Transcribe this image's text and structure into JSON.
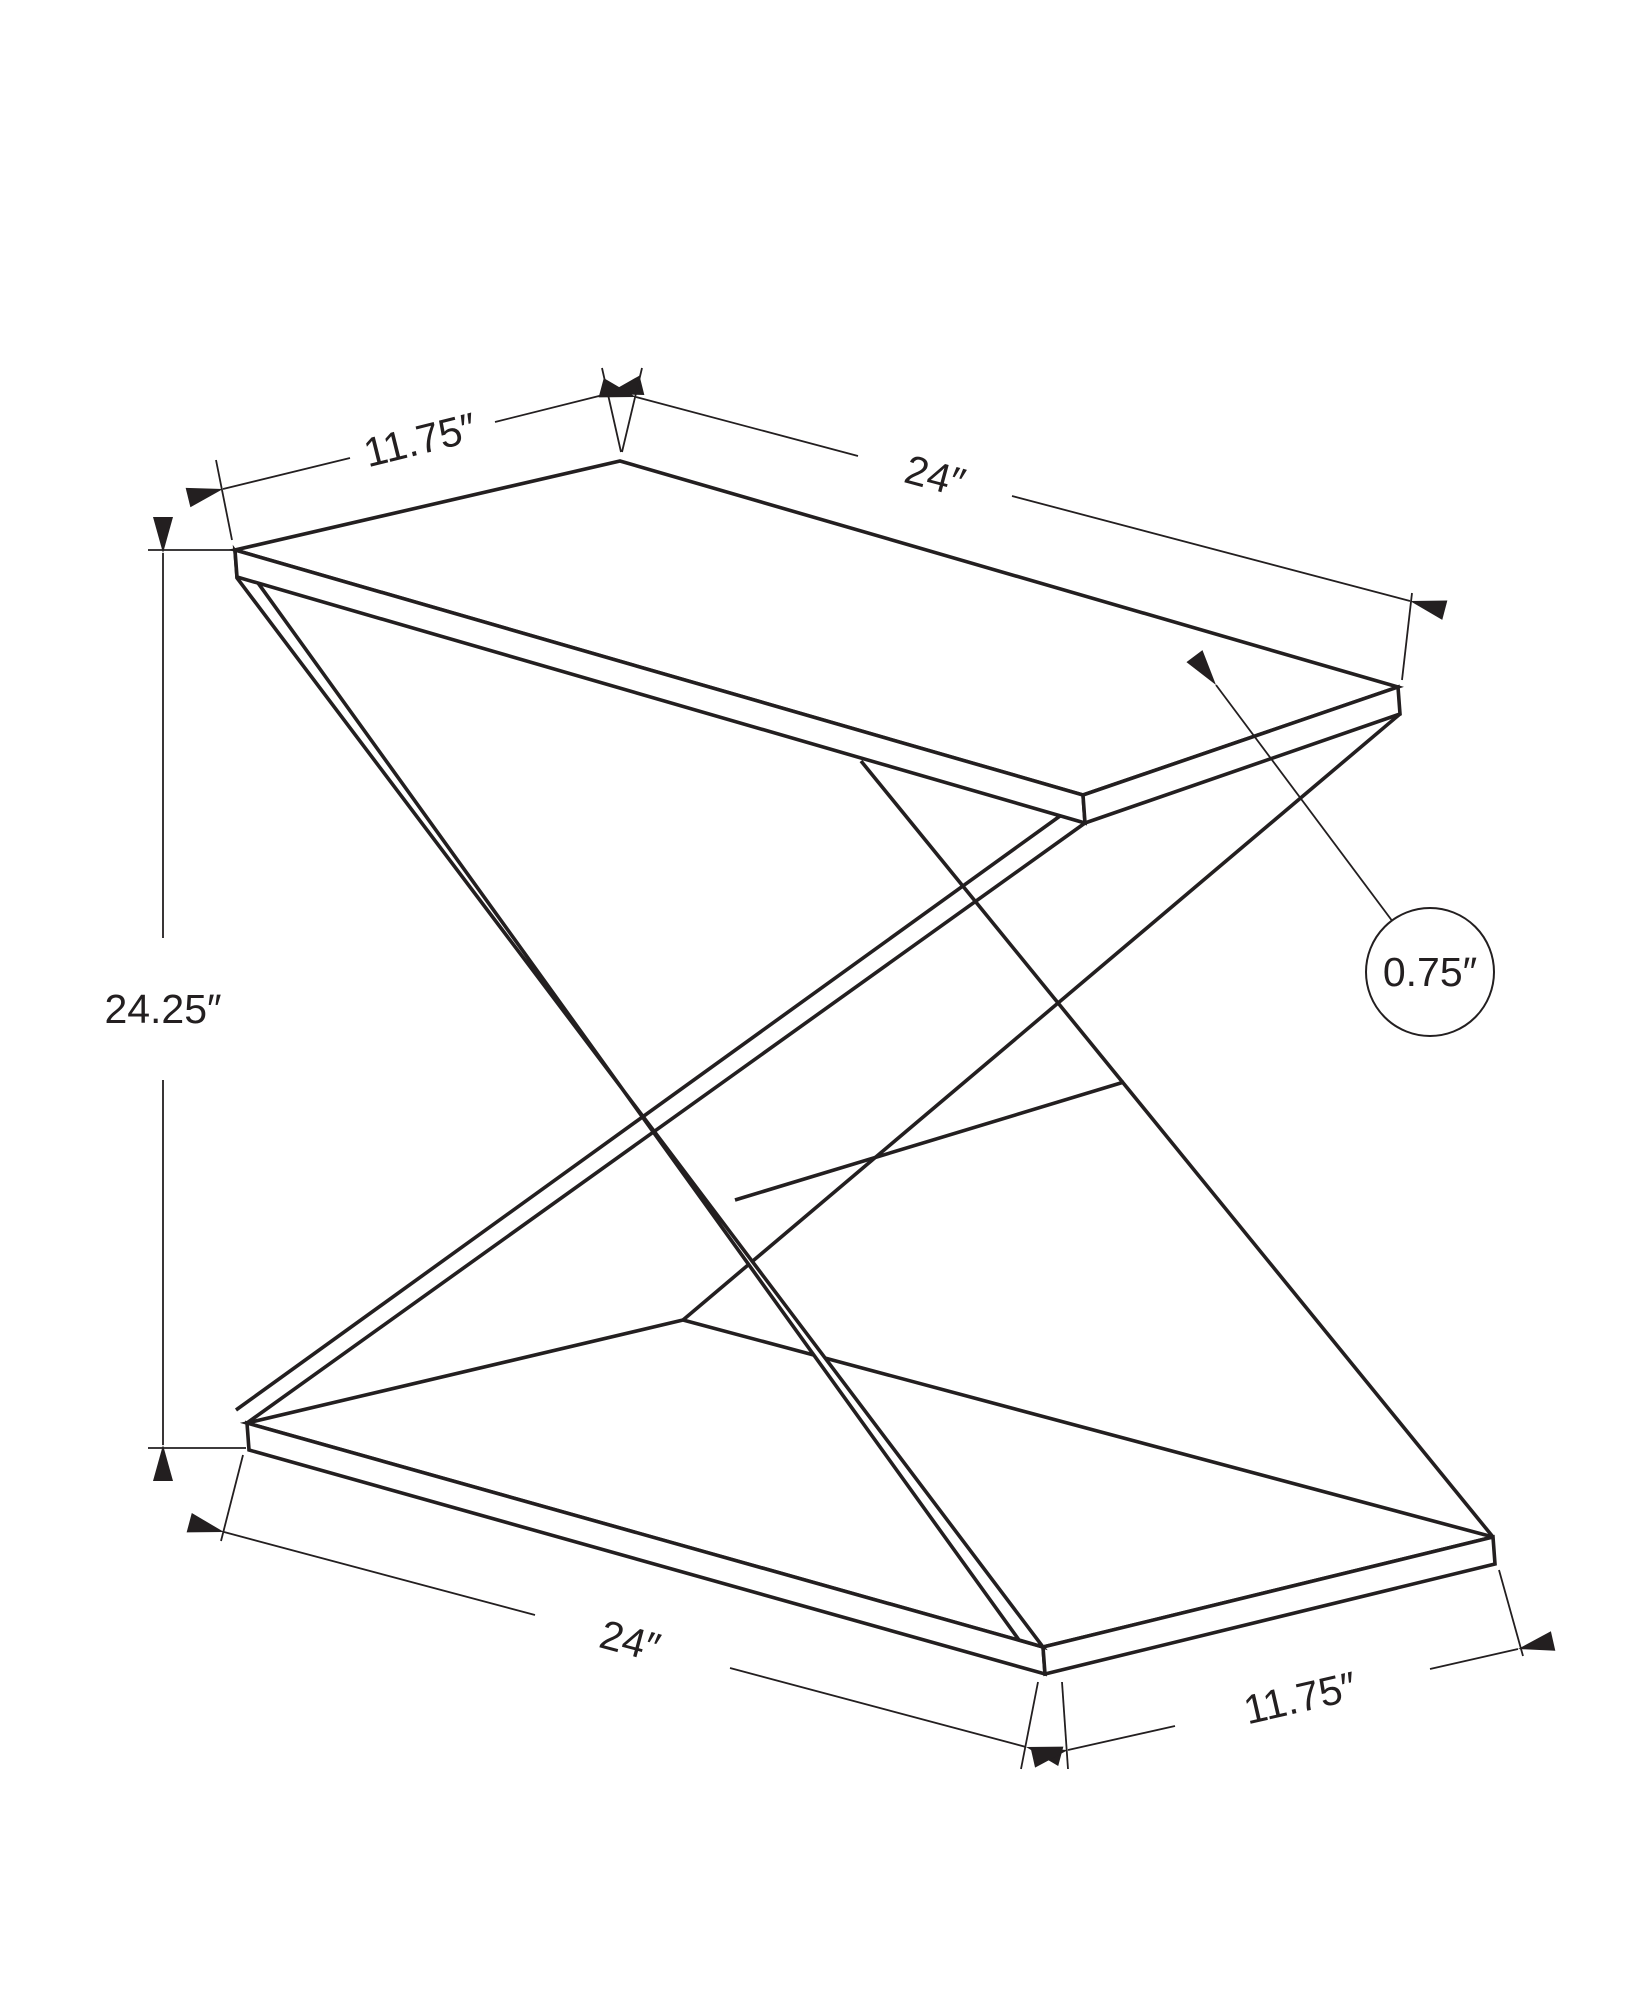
{
  "labels": {
    "top_depth": "11.75″",
    "top_width": "24″",
    "height": "24.25″",
    "thickness": "0.75″",
    "base_width": "24″",
    "base_depth": "11.75″"
  },
  "colors": {
    "line": "#231f20",
    "background": "#ffffff"
  }
}
